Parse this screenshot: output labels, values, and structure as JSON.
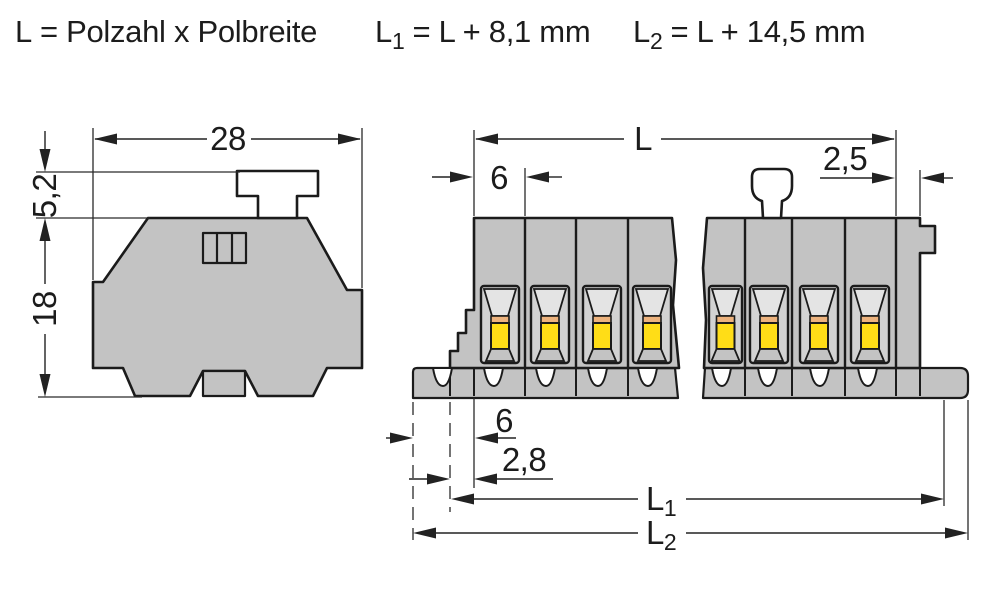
{
  "title_formulas": {
    "pole_length": {
      "label": "L",
      "rest": "= Polzahl x Polbreite"
    },
    "l1": {
      "label": "L",
      "sub": "1",
      "rest": "= L + 8,1 mm"
    },
    "l2": {
      "label": "L",
      "sub": "2",
      "rest": "= L + 14,5 mm"
    }
  },
  "side_view": {
    "description": "side profile view of terminal block",
    "dims": {
      "width": "28",
      "upper_height": "5,2",
      "total_height": "18"
    }
  },
  "front_view": {
    "description": "front view of multi-pole terminal strip with break lines",
    "dims": {
      "total_length": "L",
      "pole_pitch": "6",
      "end_plate": "2,5",
      "foot_pitch": "6",
      "foot_offset": "2,8",
      "l1_label": "L",
      "l1_sub": "1",
      "l2_label": "L",
      "l2_sub": "2"
    },
    "clamps_x": [
      481,
      531,
      583,
      633,
      709,
      750,
      800,
      851
    ],
    "clamp_widths": [
      38,
      38,
      38,
      38,
      33,
      38,
      38,
      38
    ],
    "pole_dividers": [
      525,
      576,
      628,
      745,
      792,
      845,
      896
    ],
    "base_slots": [
      450,
      474,
      525,
      576,
      628,
      745,
      792,
      845,
      896,
      920
    ],
    "base_notches": [
      433,
      484,
      536,
      588,
      638,
      712,
      758,
      810,
      858
    ]
  },
  "colors": {
    "body_gray": "#c3c3c3",
    "clamp_frame": "#d2d2d2",
    "funnel_gray": "#e4e4e4",
    "clamp_yellow": "#ffdd17",
    "clamp_orange": "#edb37e",
    "outline": "#1b1b1b",
    "dim_line": "#222222",
    "background": "#ffffff"
  }
}
